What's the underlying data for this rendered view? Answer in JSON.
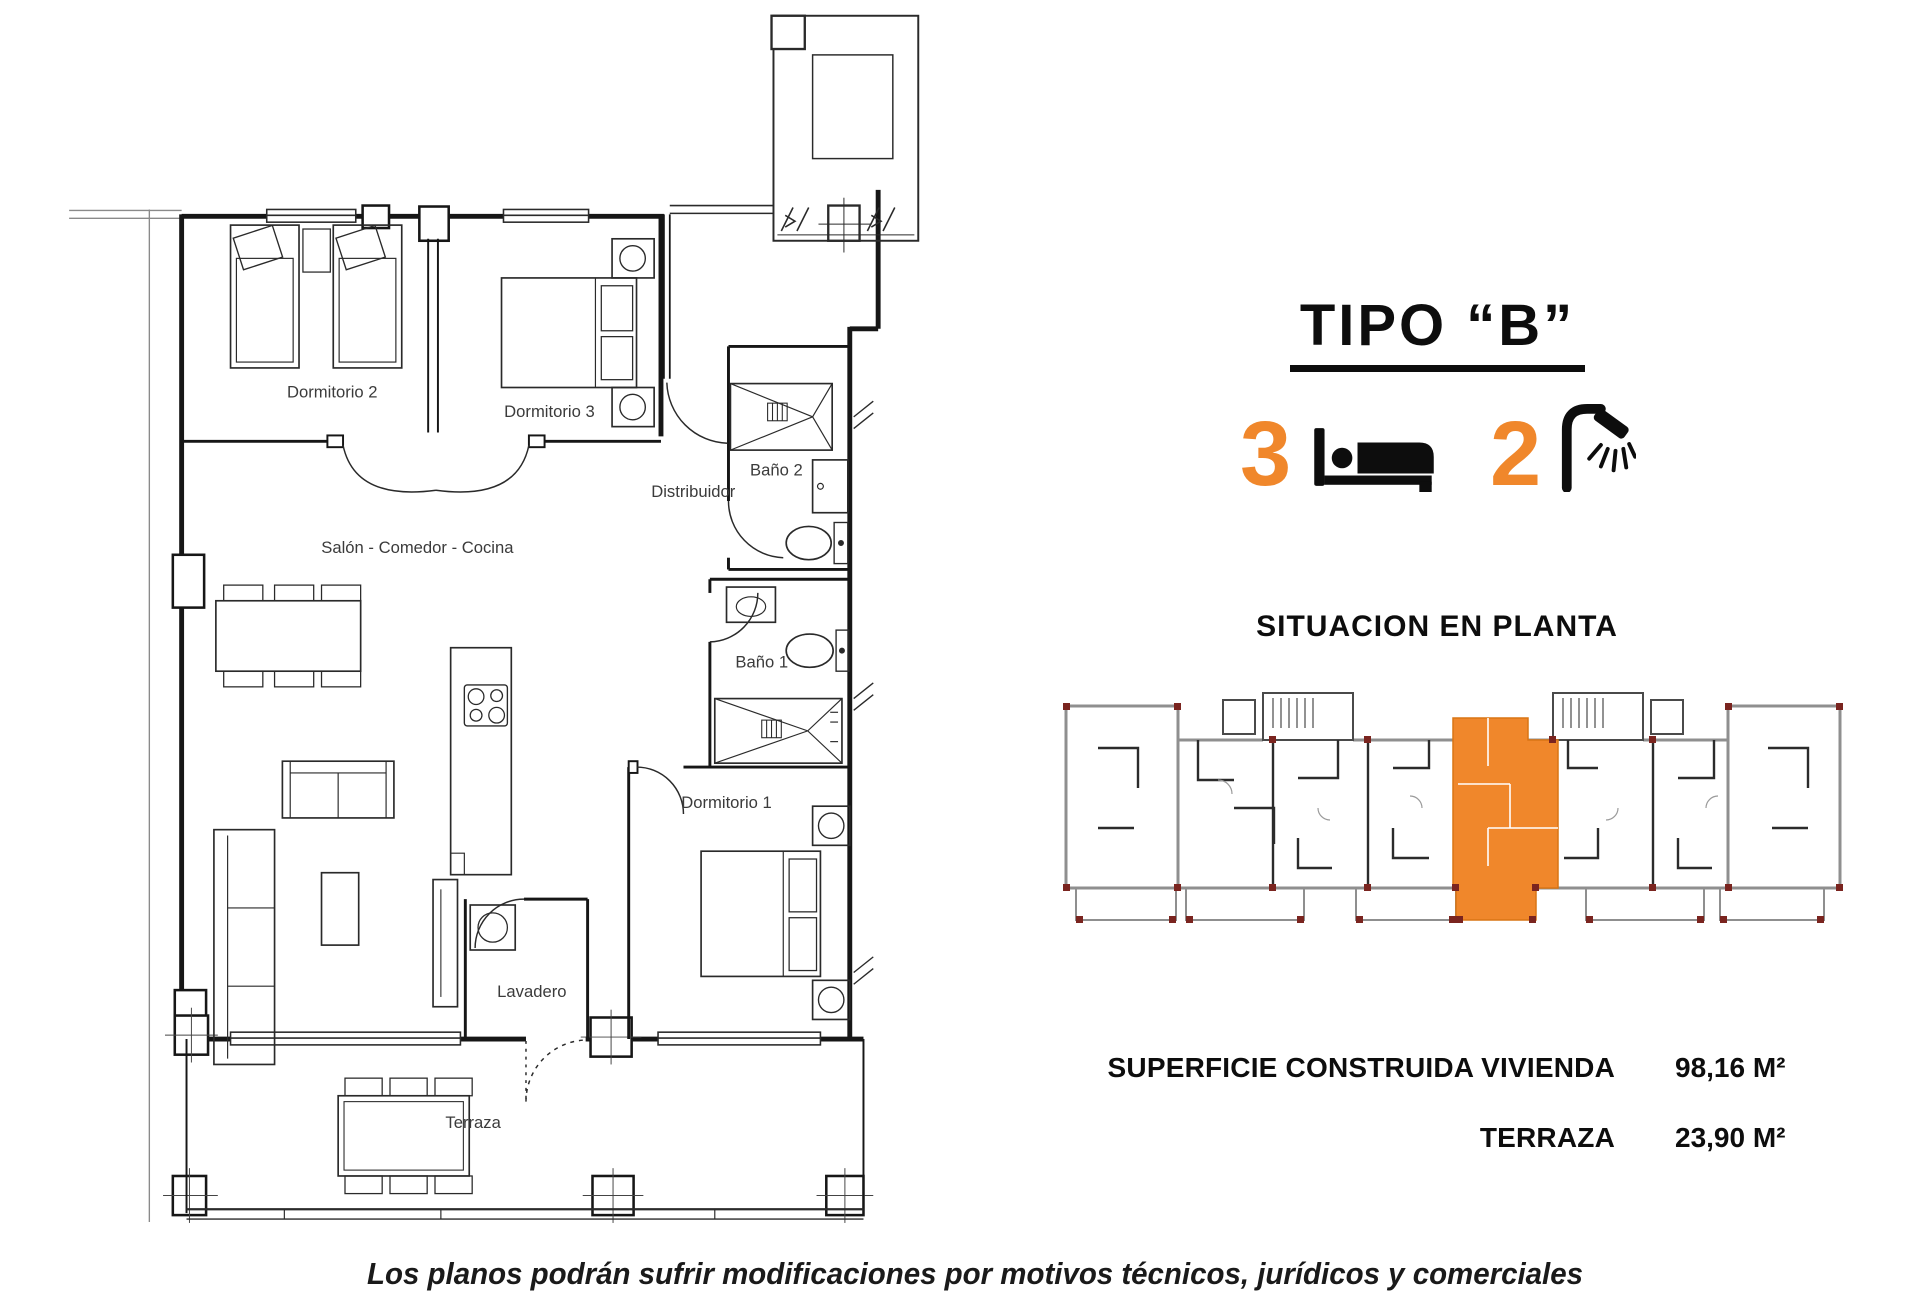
{
  "colors": {
    "accent": "#F0872B",
    "plan_line": "#1c1c1c",
    "site_gray": "#8f8f8f",
    "marker_red": "#7a241f"
  },
  "floor_plan": {
    "rooms": {
      "dormitorio2": "Dormitorio 2",
      "dormitorio3": "Dormitorio 3",
      "bano2": "Baño 2",
      "distribuidor": "Distribuidor",
      "salon": "Salón - Comedor - Cocina",
      "bano1": "Baño 1",
      "dormitorio1": "Dormitorio 1",
      "lavadero": "Lavadero",
      "terraza": "Terraza"
    }
  },
  "info_panel": {
    "title": "TIPO “B”",
    "bedrooms_count": "3",
    "bathrooms_count": "2",
    "situation_heading": "SITUACION EN PLANTA",
    "areas": [
      {
        "label": "SUPERFICIE CONSTRUIDA VIVIENDA",
        "value": "98,16 M²"
      },
      {
        "label": "TERRAZA",
        "value": "23,90 M²"
      }
    ]
  },
  "footer": {
    "disclaimer": "Los planos podrán sufrir modificaciones por motivos técnicos, jurídicos y comerciales"
  }
}
